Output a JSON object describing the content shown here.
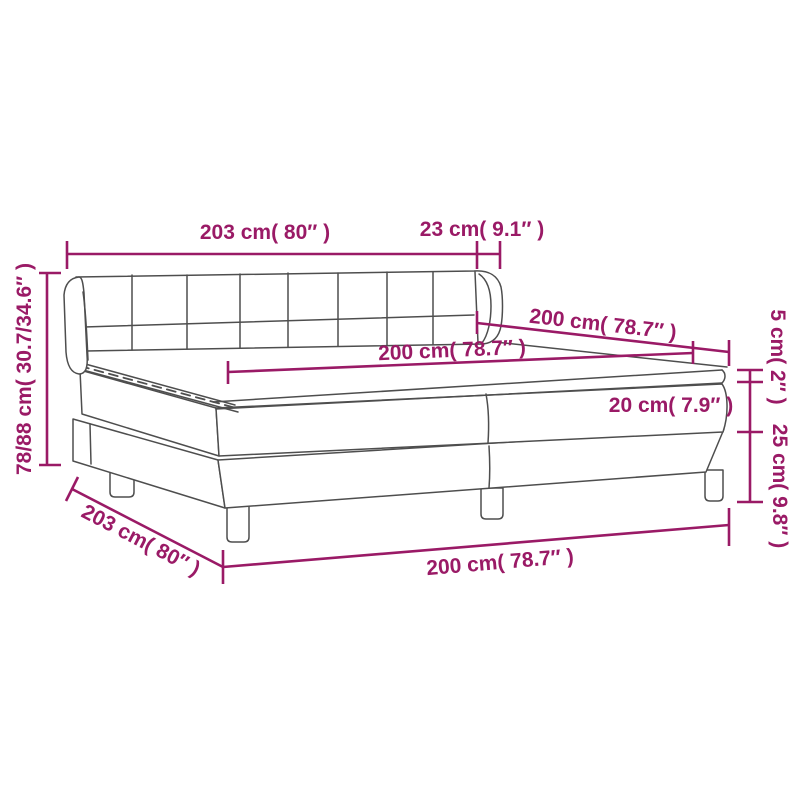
{
  "diagram": {
    "title": "Box spring bed dimension diagram",
    "type": "product-dimension-drawing",
    "colors": {
      "dimension": "#9a1a66",
      "line_art": "#4e4e4e",
      "background": "#ffffff"
    },
    "dimensions": {
      "headboard_width": {
        "label": "203 cm( 80″ )"
      },
      "wing_depth": {
        "label": "23 cm( 9.1″ )"
      },
      "length_top": {
        "label": "200 cm( 78.7″ )"
      },
      "mattress_length": {
        "label": "200 cm( 78.7″ )"
      },
      "length_bottom": {
        "label": "200 cm( 78.7″ )"
      },
      "base_width": {
        "label": "203 cm( 80″ )"
      },
      "total_height": {
        "label": "78/88 cm( 30.7/34.6″ )"
      },
      "topper_thickness": {
        "label": "5 cm( 2″ )"
      },
      "mattress_thickness": {
        "label": "20 cm( 7.9″ )"
      },
      "base_height": {
        "label": "25 cm( 9.8″ )"
      }
    }
  }
}
